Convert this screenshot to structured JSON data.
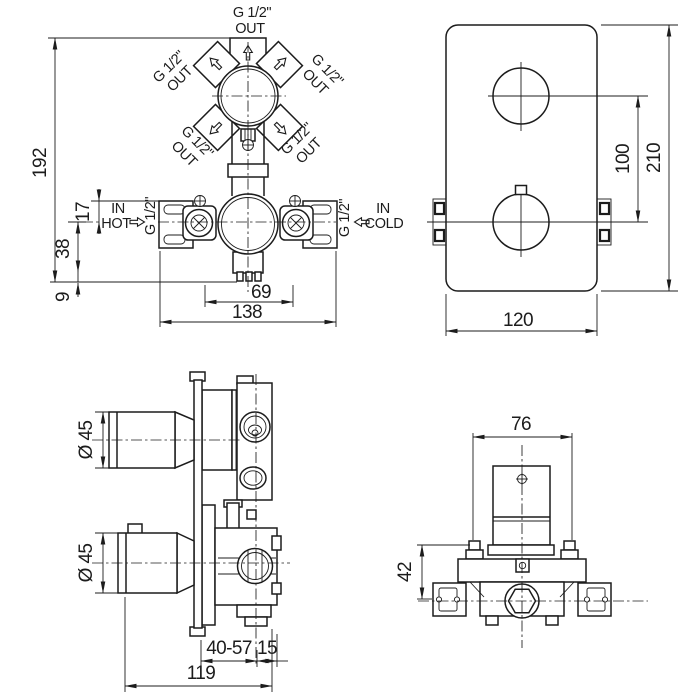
{
  "drawing": {
    "front_view": {
      "outlets": [
        {
          "thread": "G 1/2\"",
          "dir": "OUT"
        },
        {
          "thread": "G 1/2\"",
          "dir": "OUT"
        },
        {
          "thread": "G 1/2\"",
          "dir": "OUT"
        },
        {
          "thread": "G 1/2\"",
          "dir": "OUT"
        },
        {
          "thread": "G 1/2\"",
          "dir": "OUT"
        }
      ],
      "inlet_hot": {
        "line1": "IN",
        "line2": "HOT",
        "thread": "G 1/2\""
      },
      "inlet_cold": {
        "line1": "IN",
        "line2": "COLD",
        "thread": "G 1/2\""
      },
      "dims": {
        "total_height": "192",
        "bracket_to_axis": "17",
        "axis_to_base": "38",
        "base_offset": "9",
        "outlet_spacing": "69",
        "bracket_width": "138"
      }
    },
    "trim_view": {
      "dims": {
        "handle_spacing": "100",
        "plate_height": "210",
        "plate_width": "120"
      }
    },
    "side_view": {
      "dims": {
        "top_handle_diameter": "Ø 45",
        "bottom_handle_diameter": "Ø 45",
        "install_depth_range": "40-57",
        "cartridge_offset": "15",
        "total_depth": "119"
      }
    },
    "rough_in_view": {
      "dims": {
        "body_width": "76",
        "body_height": "42"
      }
    }
  }
}
